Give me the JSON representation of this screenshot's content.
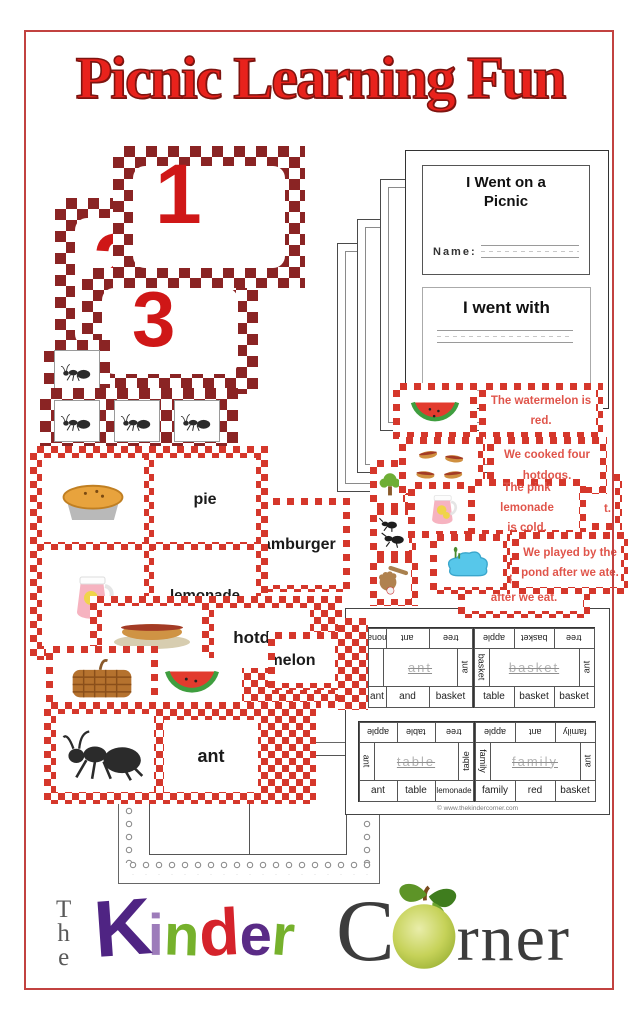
{
  "page": {
    "title": "Picnic Learning Fun",
    "watermark": "© www.thekindercorner.com"
  },
  "colors": {
    "title_red": "#e8221c",
    "maroon_checker": "#8a2424",
    "red_checker": "#d5372b",
    "strip_text_red": "#e0554b",
    "number_red": "#cf1717",
    "border_red": "#c24240"
  },
  "number_cards": {
    "cards": [
      "1",
      "2",
      "3"
    ],
    "ant_counts": [
      1,
      3
    ]
  },
  "booklet": {
    "title_line1": "I Went on a",
    "title_line2": "Picnic",
    "name_label": "Name:",
    "page2_title": "I went with"
  },
  "sentence_strips": [
    {
      "icon": "watermelon",
      "line1": "The watermelon is",
      "line2": "red."
    },
    {
      "icon": "hotdogs",
      "line1": "We cooked four",
      "line2": "hotdogs."
    },
    {
      "icon": "lemonade-pitcher",
      "line1": "The pink lemonade",
      "line2": "is cold."
    },
    {
      "icon": "pond",
      "line1": "We played by the",
      "line2": "pond after we ate."
    },
    {
      "icon": "baseball-glove",
      "line1": "We will play baseball",
      "line2": "after we eat."
    }
  ],
  "strip_fragment": "t.",
  "picture_cards": [
    "tree",
    "ants",
    "baseball-glove"
  ],
  "vocab": {
    "pie": "pie",
    "lemonade": "lemonade",
    "hamburger": "hamburger",
    "hotdog": "hotdog",
    "melon": "melon",
    "ant": "ant",
    "icons": [
      "pie",
      "lemonade-pitcher",
      "hotdog-plate",
      "watermelon",
      "basket",
      "ant"
    ]
  },
  "word_work": {
    "sheets": [
      {
        "top": [
          "lemonade",
          "ant",
          "tree"
        ],
        "side_left": "",
        "trace": "ant",
        "side_right": "ant",
        "bottom": [
          "ant",
          "and",
          "basket"
        ]
      },
      {
        "top": [
          "apple",
          "basket",
          "tree"
        ],
        "side_left": "basket",
        "trace": "basket",
        "side_right": "ant",
        "bottom": [
          "table",
          "basket",
          "basket"
        ]
      },
      {
        "top": [
          "apple",
          "table",
          "tree"
        ],
        "side_left": "ant",
        "trace": "table",
        "side_right": "table",
        "bottom": [
          "ant",
          "table",
          "lemonade"
        ]
      },
      {
        "top": [
          "apple",
          "ant",
          "family"
        ],
        "side_left": "family",
        "trace": "family",
        "side_right": "ant",
        "bottom": [
          "family",
          "red",
          "basket"
        ]
      }
    ]
  },
  "frame_sheet": {
    "label": "makes me feel"
  },
  "logo": {
    "the": {
      "t": "T",
      "h": "h",
      "e": "e"
    },
    "letters": [
      {
        "ch": "K",
        "color": "#4f2483"
      },
      {
        "ch": "i",
        "color": "#9d7cba"
      },
      {
        "ch": "n",
        "color": "#76b12c"
      },
      {
        "ch": "d",
        "color": "#d5232b"
      },
      {
        "ch": "e",
        "color": "#5a2b86"
      },
      {
        "ch": "r",
        "color": "#76b12c"
      }
    ],
    "c": "C",
    "rner": "rner"
  }
}
